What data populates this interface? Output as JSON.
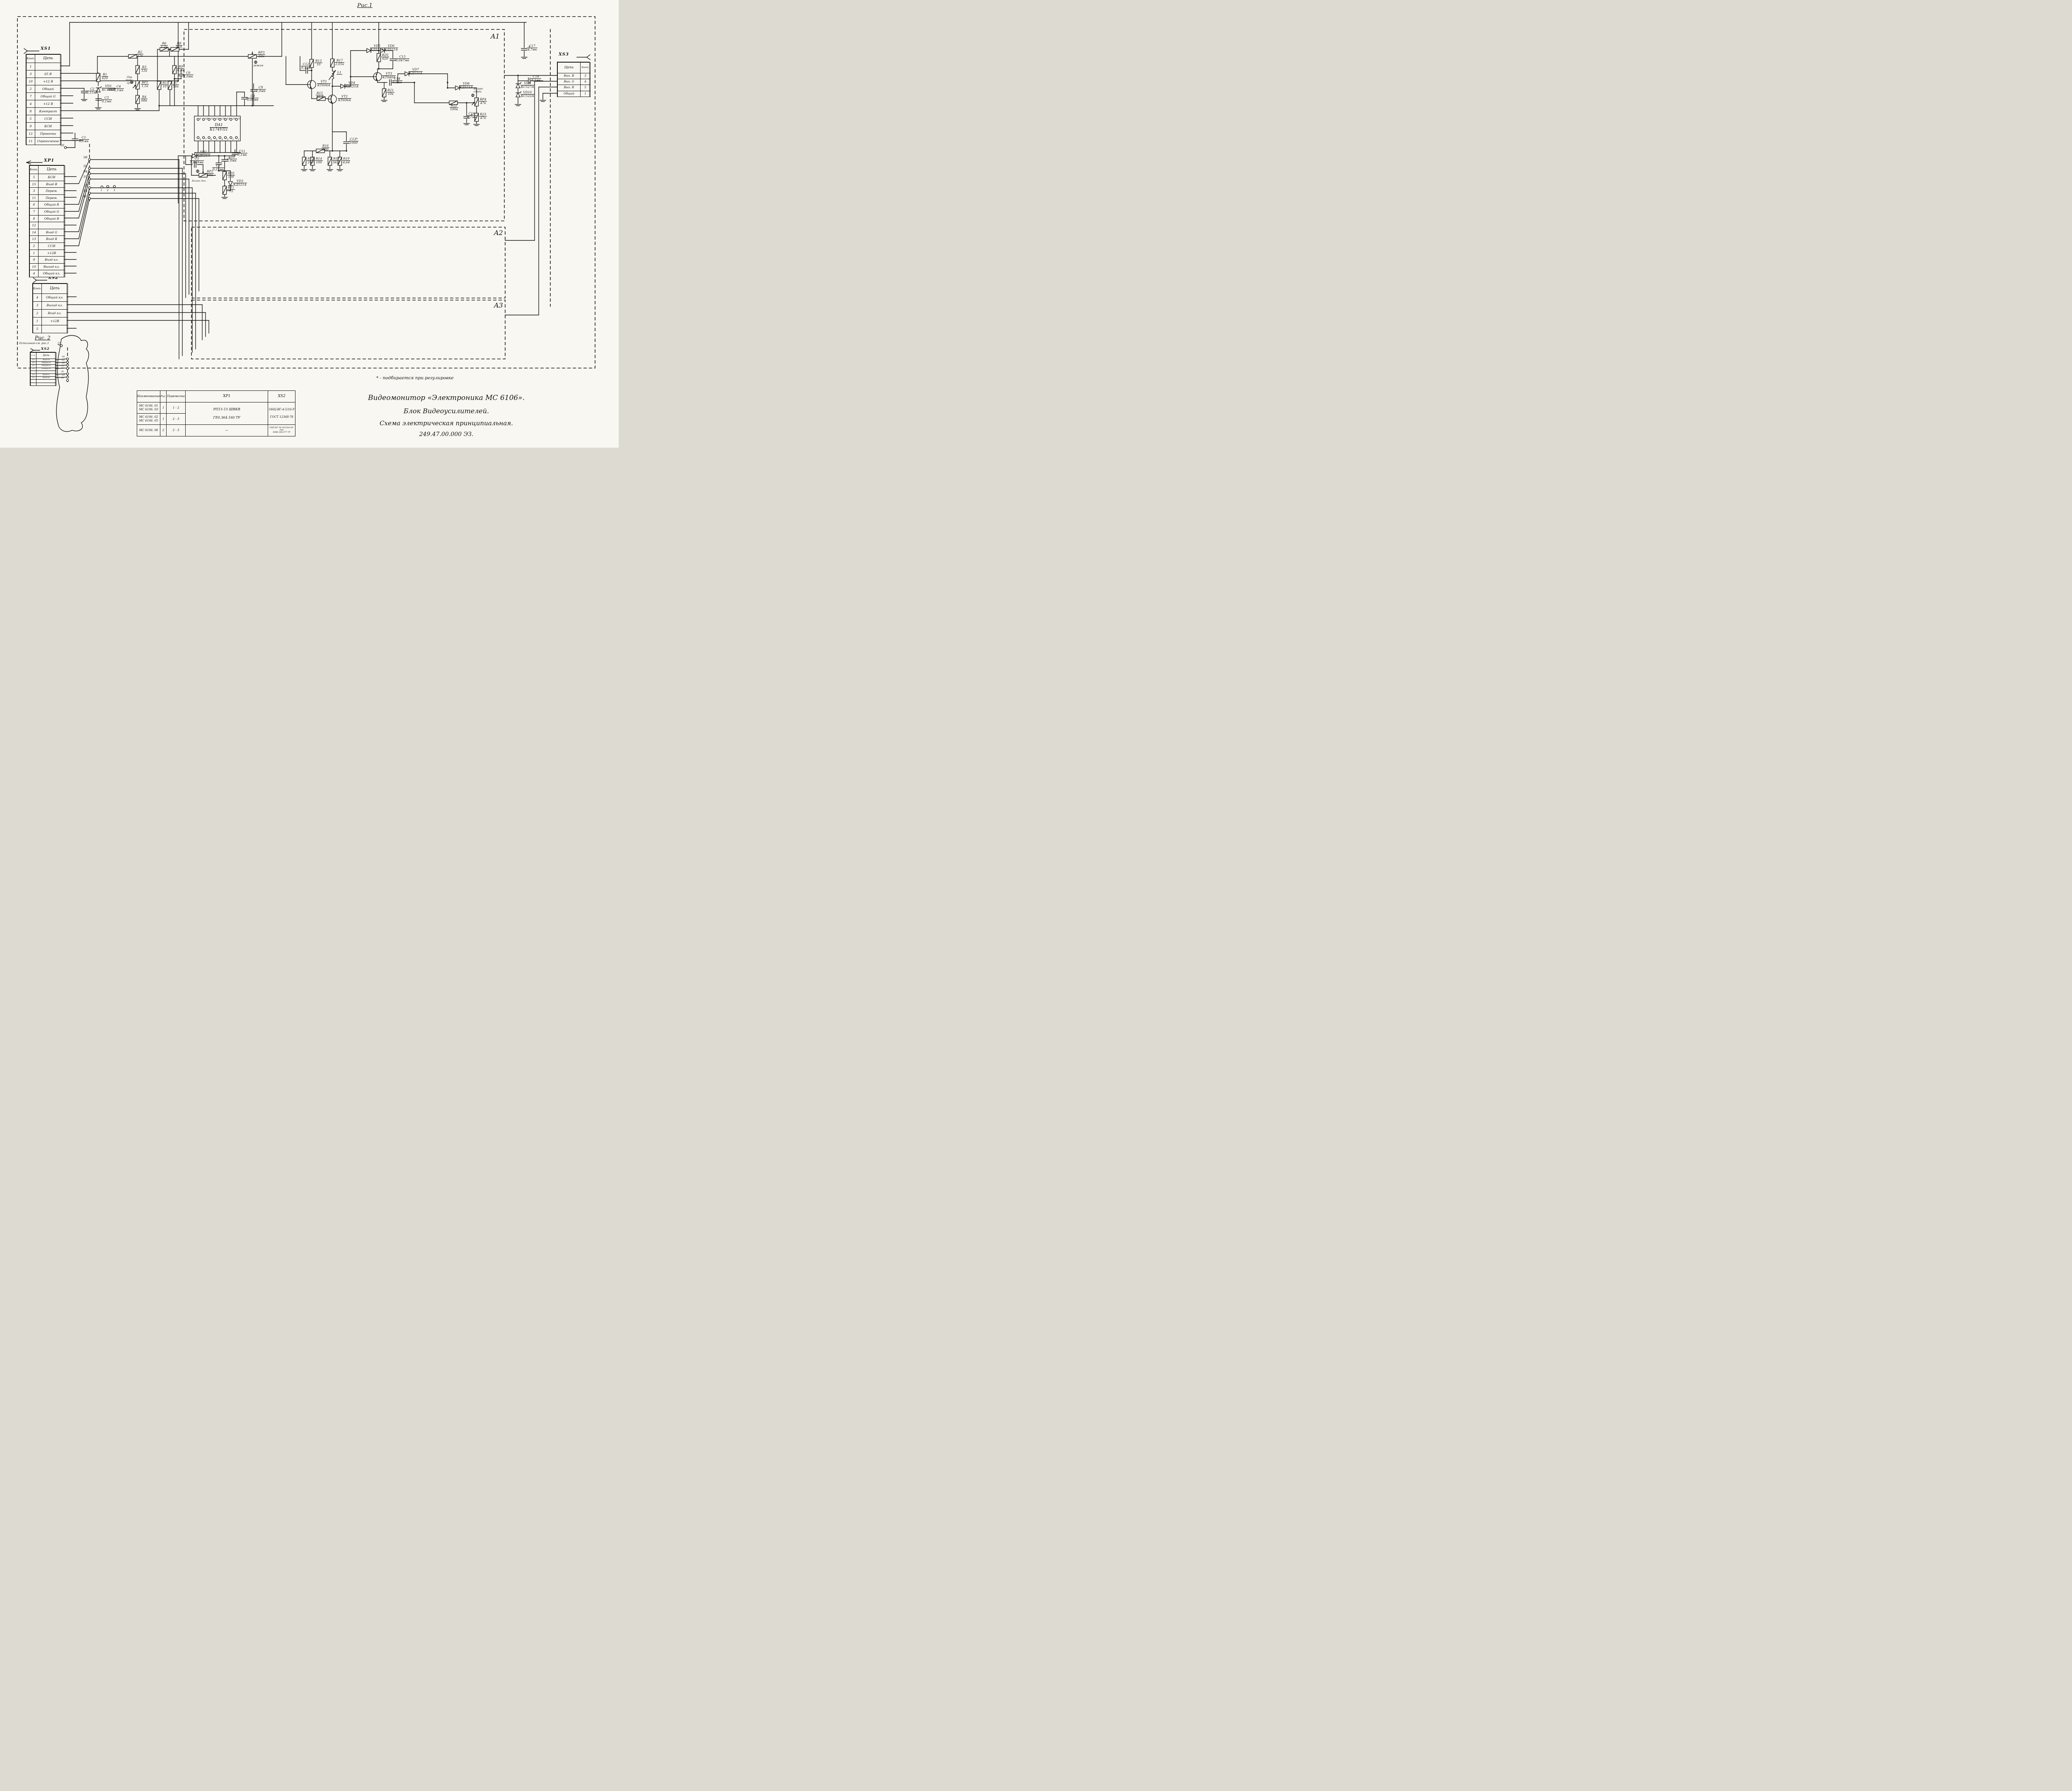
{
  "figure1": {
    "caption": "Рис.1",
    "blocks": {
      "a1": "A1",
      "a2": "A2",
      "a3": "A3"
    },
    "note": "* - подбирается при регулировке"
  },
  "figure2": {
    "caption": "Рис. 2",
    "subcaption": "Остальное-см. рис.1"
  },
  "connectors": {
    "xs1": {
      "title": "XS1",
      "pin_header": "Конт.",
      "circuit_header": "Цепь",
      "rows": [
        [
          "1",
          ""
        ],
        [
          "3",
          "65 В"
        ],
        [
          "10",
          "+12 В"
        ],
        [
          "2",
          "Общий"
        ],
        [
          "7",
          "Общий G"
        ],
        [
          "4",
          "+12 В"
        ],
        [
          "8",
          "Контраст"
        ],
        [
          "5",
          "ССИ"
        ],
        [
          "9",
          "КСИ"
        ],
        [
          "12",
          "Привязка"
        ],
        [
          "11",
          "Ограничение"
        ]
      ]
    },
    "xp1": {
      "title": "ХР1",
      "pin_header": "Конт.",
      "circuit_header": "Цепь",
      "rows": [
        [
          "5",
          "КСИ"
        ],
        [
          "15",
          "Вход В"
        ],
        [
          "3",
          "Перем."
        ],
        [
          "11",
          "Перем."
        ],
        [
          "6",
          "Общий R"
        ],
        [
          "7",
          "Общий G"
        ],
        [
          "8",
          "Общий В"
        ],
        [
          "12",
          ""
        ],
        [
          "14",
          "Вход G"
        ],
        [
          "13",
          "Вход R"
        ],
        [
          "2",
          "ССИ"
        ],
        [
          "1",
          "+12В"
        ],
        [
          "9",
          "Вход кл."
        ],
        [
          "10",
          "Выход кл."
        ],
        [
          "4",
          "Общий кл."
        ]
      ]
    },
    "xs2": {
      "title": "XS2",
      "pin_header": "Конт.",
      "circuit_header": "Цепь",
      "rows": [
        [
          "4",
          "Общий кл."
        ],
        [
          "3",
          "Выход кл."
        ],
        [
          "2",
          "Вход кл."
        ],
        [
          "1",
          "+12В"
        ],
        [
          "5",
          ""
        ]
      ]
    },
    "xs2_fig2": {
      "title": "XS2",
      "pin_header": "Конт.",
      "circuit_header": "Цепь",
      "rows": [
        [
          "15",
          "Вход В"
        ],
        [
          "10",
          "Общий R"
        ],
        [
          "12",
          "Общий G"
        ],
        [
          "14",
          "Общий В"
        ],
        [
          "",
          ""
        ],
        [
          "13",
          "Вход G"
        ],
        [
          "11",
          "Вход R"
        ],
        [
          "",
          ""
        ],
        [
          "",
          ""
        ]
      ]
    },
    "xs3": {
      "title": "XS3",
      "pin_header": "Конт.",
      "circuit_header": "Цепь",
      "rows": [
        [
          "Вых. В",
          "3"
        ],
        [
          "Вых. G",
          "4"
        ],
        [
          "Вых. R",
          "5"
        ],
        [
          "Общий",
          "1"
        ]
      ]
    }
  },
  "components": [
    {
      "ref": "R1",
      "value": "620"
    },
    {
      "ref": "R2",
      "value": "12к"
    },
    {
      "ref": "R3",
      "value": "12к"
    },
    {
      "ref": "R4",
      "value": "68к"
    },
    {
      "ref": "R5",
      "value": "10"
    },
    {
      "ref": "R6",
      "value": "1,2к"
    },
    {
      "ref": "R7",
      "value": "56к"
    },
    {
      "ref": "R8",
      "value": "820"
    },
    {
      "ref": "R9",
      "value": "6,8к"
    },
    {
      "ref": "R10",
      "value": "100"
    },
    {
      "ref": "R11",
      "value": "75"
    },
    {
      "ref": "R12",
      "value": "240"
    },
    {
      "ref": "R13",
      "value": "10"
    },
    {
      "ref": "R14",
      "value": "100"
    },
    {
      "ref": "R15",
      "value": "46,4"
    },
    {
      "ref": "R16",
      "value": "580"
    },
    {
      "ref": "R17",
      "value": "2,05к"
    },
    {
      "ref": "R18",
      "value": "56,2"
    },
    {
      "ref": "R19",
      "value": "4,64"
    },
    {
      "ref": "R20",
      "value": "620"
    },
    {
      "ref": "R21",
      "value": "10к"
    },
    {
      "ref": "R22",
      "value": "100к"
    },
    {
      "ref": "R23",
      "value": "47к"
    },
    {
      "ref": "RP1",
      "value": "1,5к"
    },
    {
      "ref": "RP2",
      "value": "10к"
    },
    {
      "ref": "RP3",
      "value": "22к"
    },
    {
      "ref": "RP4",
      "value": "47к"
    },
    {
      "ref": "C1",
      "value": "0,1мк"
    },
    {
      "ref": "C2",
      "value": "0,15мк"
    },
    {
      "ref": "C3",
      "value": "0,1мк"
    },
    {
      "ref": "C4",
      "value": "0,1мк"
    },
    {
      "ref": "C5",
      "value": "0,068мк"
    },
    {
      "ref": "C6",
      "value": "1,0мк"
    },
    {
      "ref": "C7",
      "value": "0,22мк"
    },
    {
      "ref": "C8",
      "value": "0,01мк"
    },
    {
      "ref": "C9",
      "value": "1,0мк"
    },
    {
      "ref": "C10",
      "value": "1,0мк"
    },
    {
      "ref": "C11",
      "value": "0,1мк"
    },
    {
      "ref": "C12",
      "value": "0,1мк"
    },
    {
      "ref": "C13*",
      "value": "1000"
    },
    {
      "ref": "C14",
      "value": "0,1мк"
    },
    {
      "ref": "C15",
      "value": "0,047мк"
    },
    {
      "ref": "C16",
      "value": "4,7мк"
    },
    {
      "ref": "C17",
      "value": "4,7мк"
    },
    {
      "ref": "C18",
      "value": "0,1мк"
    },
    {
      "ref": "VD1",
      "value": "КС156А"
    },
    {
      "ref": "VD2",
      "value": "КД521А"
    },
    {
      "ref": "VD3",
      "value": "КД521А"
    },
    {
      "ref": "VD4",
      "value": "КД521А"
    },
    {
      "ref": "VD5",
      "value": "КД521А"
    },
    {
      "ref": "VD6",
      "value": "КД521А"
    },
    {
      "ref": "VD7",
      "value": "КД521А"
    },
    {
      "ref": "VD8",
      "value": "КД521А"
    },
    {
      "ref": "VD9",
      "value": "КС527А"
    },
    {
      "ref": "VD10",
      "value": "КС522А"
    },
    {
      "ref": "VT1",
      "value": "КТ606А"
    },
    {
      "ref": "VT2",
      "value": "КТ606А"
    },
    {
      "ref": "VT3",
      "value": "КТ940А"
    },
    {
      "ref": "L1",
      "value": ""
    }
  ],
  "ic": {
    "ref": "DA1",
    "part": "К174УП1",
    "pins_top": [
      "9",
      "10",
      "11",
      "12",
      "13",
      "14",
      "15",
      "16"
    ],
    "pins_bottom": [
      "8",
      "7",
      "6",
      "5",
      "4",
      "3",
      "2",
      "1"
    ]
  },
  "annotations": {
    "rp1": "Огр.\nтока\nлуча",
    "rp2": "Баланс дин.",
    "rp3": "режим",
    "rp4": "Баланс\nстат."
  },
  "nodes": {
    "fig1": [
      "Э1",
      "Э8",
      "Э2",
      "Э4",
      "Э7",
      "Э5",
      "Э3",
      "Э6"
    ],
    "fig2": [
      "Э1",
      "Э8",
      "Э2",
      "Э4",
      "Э7",
      "Э5",
      "Э3",
      "Э6"
    ],
    "pads": [
      "1",
      "2",
      "3"
    ]
  },
  "jumper_table": {
    "headers": [
      "Наименование",
      "Рис.",
      "Перемычка",
      "ХР1",
      "XS2"
    ],
    "rows": [
      {
        "name": "МС 6106. 01\nМС 6106. 03",
        "fig": "1",
        "jumper": "1 - 2"
      },
      {
        "name": "МС 6106. 02\nМС 6106. 05",
        "fig": "1",
        "jumper": "2 - 3"
      },
      {
        "name": "МС 6106. 06",
        "fig": "2",
        "jumper": "2 - 3"
      }
    ],
    "xp1_cell": "РП15-15 ШВКВ\n\nГЕ0.364.160 ТУ",
    "xs2_cell": "ОНЦ-ВГ-4-5/16-Р\n\nГОСТ 12368-78",
    "xp1_last": "—",
    "xs2_last": "ОНП-КГ-56-16/254×85-Р50\nНЩ0.364.077 ТУ"
  },
  "title_block": {
    "line1": "Видеомонитор «Электроника МС 6106».",
    "line2": "Блок    Видеоусилителей.",
    "line3": "Схема электрическая    принципиальная.",
    "line4": "249.47.00.000 ЭЗ."
  }
}
